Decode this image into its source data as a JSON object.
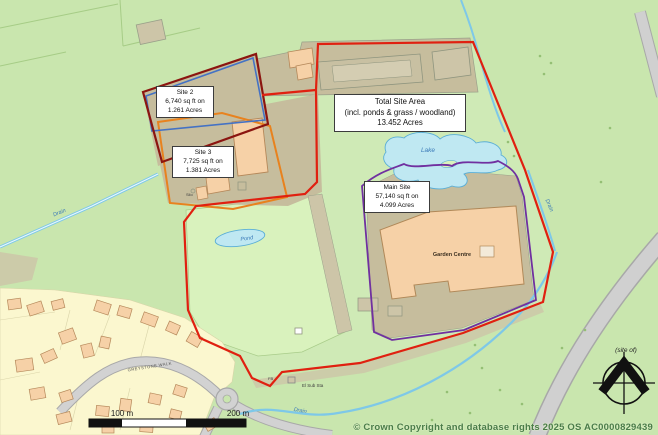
{
  "annotations": {
    "site2": {
      "line1": "Site 2",
      "line2": "6,740 sq ft on",
      "line3": "1.261 Acres"
    },
    "site3": {
      "line1": "Site 3",
      "line2": "7,725 sq ft on",
      "line3": "1.381 Acres"
    },
    "total_site": {
      "line1": "Total Site Area",
      "line2": "(incl. ponds & grass / woodland)",
      "line3": "13.452 Acres"
    },
    "main_site": {
      "line1": "Main Site",
      "line2": "57,140 sq ft on",
      "line3": "4.099 Acres"
    }
  },
  "map_labels": {
    "lake": "Lake",
    "pond": "Pond",
    "garden_centre": "Garden Centre",
    "drain_left": "Drain",
    "drain_right": "Drain",
    "drain_bottom": "Drain",
    "el_sub_sta": "El Sub Sta",
    "fb": "FB",
    "silo": "Silo",
    "site_of": "(site of)",
    "road_name": "GREYSTONE WALK"
  },
  "scale_bar": {
    "label_100": "100 m",
    "label_200": "200 m"
  },
  "attribution": "© Crown Copyright and database rights 2025 OS AC0000829439",
  "legend_colors": {
    "main_site_boundary": "#e02010",
    "site2_boundary": "#8b1510",
    "site2_inner_boundary": "#4472c4",
    "site3_boundary": "#e8821e",
    "inner_area_boundary": "#7030a0",
    "water_fill": "#bfe8f2",
    "field_green": "#c9e6ae",
    "yard_tan": "#c6bd9d",
    "building_peach": "#f6d1a7",
    "residential_fill": "#fbf7cf",
    "road_grey": "#d2d2d2"
  }
}
